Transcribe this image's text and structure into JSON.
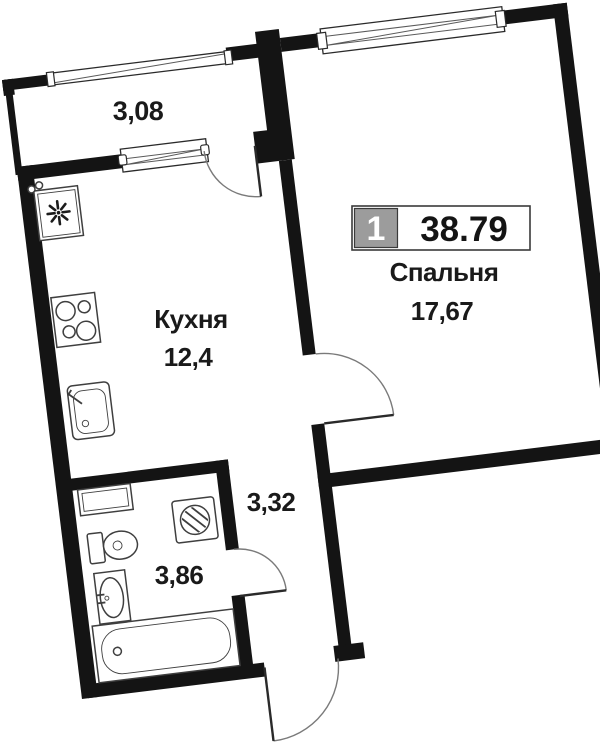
{
  "plan": {
    "badge": {
      "unit_number": "1",
      "total_area": "38.79"
    },
    "rooms": {
      "balcony": {
        "area": "3,08"
      },
      "kitchen": {
        "name": "Кухня",
        "area": "12,4"
      },
      "bedroom": {
        "name": "Спальня",
        "area": "17,67"
      },
      "hallway": {
        "area": "3,32"
      },
      "bathroom": {
        "area": "3,86"
      }
    },
    "colors": {
      "wall": "#141414",
      "fixture_line": "#3f3f3f",
      "door_line": "#7a7a7a",
      "badge_gray": "#9c9c9c",
      "text": "#1a1a1a",
      "background": "#ffffff"
    },
    "icons": [
      "vent-fan-icon",
      "stove-icon",
      "kitchen-sink-icon",
      "cabinet-icon",
      "washing-machine-icon",
      "toilet-icon",
      "washbasin-icon",
      "bathtub-icon",
      "window-icon",
      "door-arc-icon"
    ]
  }
}
